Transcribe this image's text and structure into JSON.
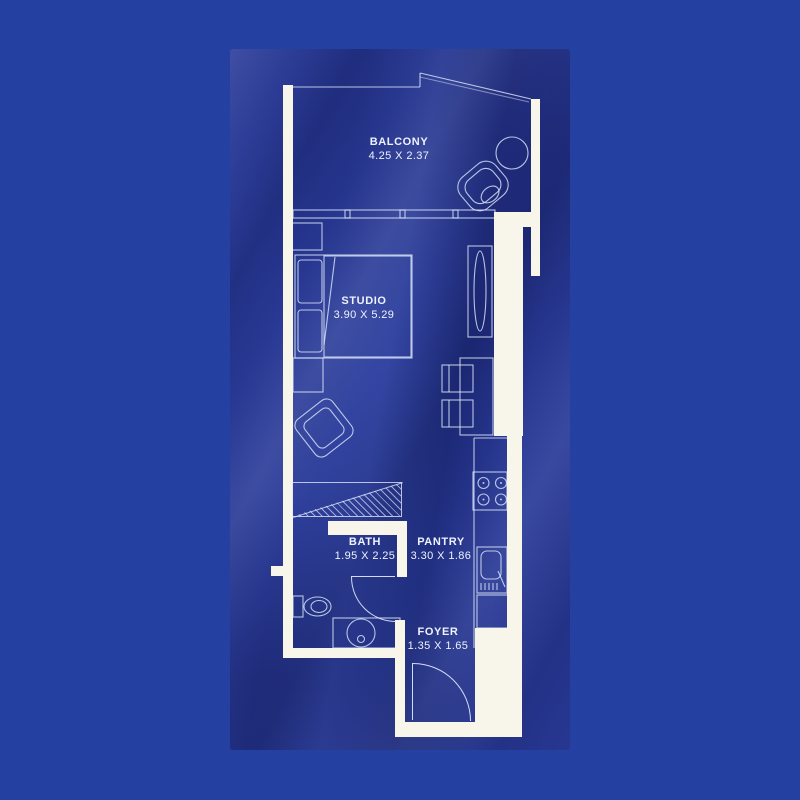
{
  "plan": {
    "title": "studio-apartment-floor-plan",
    "rooms": [
      {
        "id": "balcony",
        "name": "BALCONY",
        "dimensions": "4.25 X 2.37"
      },
      {
        "id": "studio",
        "name": "STUDIO",
        "dimensions": "3.90 X 5.29"
      },
      {
        "id": "bath",
        "name": "BATH",
        "dimensions": "1.95 X 2.25"
      },
      {
        "id": "pantry",
        "name": "PANTRY",
        "dimensions": "3.30 X 1.86"
      },
      {
        "id": "foyer",
        "name": "FOYER",
        "dimensions": "1.35 X 1.65"
      }
    ],
    "colors": {
      "page_background": "#2441a1",
      "fabric_base": "#2a3b98",
      "wall": "#f8f5ea",
      "line": "#dce5fa",
      "text": "#eef2fd"
    }
  }
}
